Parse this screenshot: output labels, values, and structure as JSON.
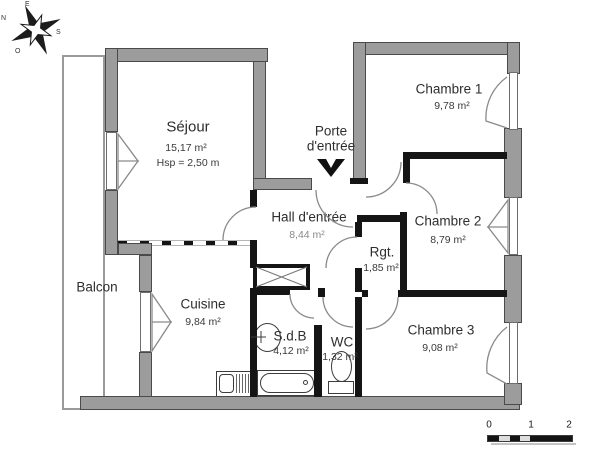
{
  "rooms": {
    "sejour": {
      "name": "Séjour",
      "area": "15,17 m²",
      "hsp": "Hsp = 2,50 m"
    },
    "chambre1": {
      "name": "Chambre 1",
      "area": "9,78 m²"
    },
    "chambre2": {
      "name": "Chambre 2",
      "area": "8,79 m²"
    },
    "chambre3": {
      "name": "Chambre 3",
      "area": "9,08 m²"
    },
    "hall": {
      "name": "Hall d'entrée",
      "area": "8,44 m²"
    },
    "rgt": {
      "name": "Rgt.",
      "area": "1,85 m²"
    },
    "cuisine": {
      "name": "Cuisine",
      "area": "9,84 m²"
    },
    "sdb": {
      "name": "S.d.B",
      "area": "4,12 m²"
    },
    "wc": {
      "name": "WC",
      "area": "1,32 m²"
    },
    "balcon": {
      "name": "Balcon"
    }
  },
  "entrance": {
    "label_line1": "Porte",
    "label_line2": "d'entrée"
  },
  "compass": {
    "north": "N",
    "south": "S",
    "east": "E",
    "west": "O"
  },
  "scale_bar": {
    "labels": [
      "0",
      "1",
      "2"
    ]
  },
  "icons": {
    "compass": "compass-rose",
    "entrance_arrow": "▼",
    "bathtub": "bathtub-shape",
    "toilet": "toilet-shape",
    "sink": "sink-oval",
    "kitchen_sink": "sink-and-drainer",
    "closet": "crossed-box"
  },
  "colors": {
    "exterior_wall": "#9c9c9c",
    "interior_wall": "#151515",
    "door_arc": "#8a8a8a",
    "text": "#2e2e2e",
    "background": "#ffffff"
  }
}
